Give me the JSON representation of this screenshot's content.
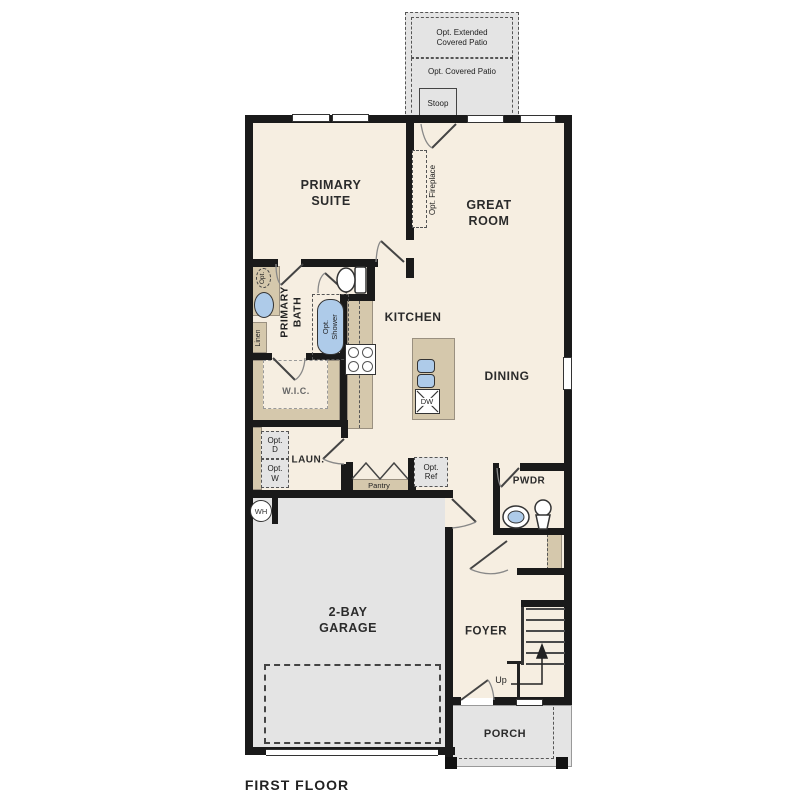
{
  "title": "FIRST FLOOR",
  "patio": {
    "extended": "Opt. Extended\nCovered Patio",
    "covered": "Opt. Covered Patio",
    "stoop": "Stoop"
  },
  "rooms": {
    "primary_suite": "PRIMARY\nSUITE",
    "great_room": "GREAT\nROOM",
    "kitchen": "KITCHEN",
    "dining": "DINING",
    "primary_bath": "PRIMARY\nBATH",
    "wic": "W.I.C.",
    "laundry": "LAUN.",
    "powder": "PWDR",
    "garage": "2-BAY\nGARAGE",
    "foyer": "FOYER",
    "porch": "PORCH"
  },
  "options": {
    "fireplace": "Opt. Fireplace",
    "shower": "Opt.\nShower",
    "dryer": "Opt.\nD",
    "washer": "Opt.\nW",
    "refrigerator": "Opt.\nRef",
    "second_sink": "Opt."
  },
  "labels": {
    "pantry": "Pantry",
    "linen": "Linen",
    "dishwasher": "DW",
    "water_heater": "WH",
    "stairs_direction": "Up"
  },
  "colors": {
    "floor": "#f6eee1",
    "concrete": "#e4e4e4",
    "counter": "#d5c8ac",
    "wall": "#1a1a1a",
    "fixture_blue": "#aecbe9"
  }
}
